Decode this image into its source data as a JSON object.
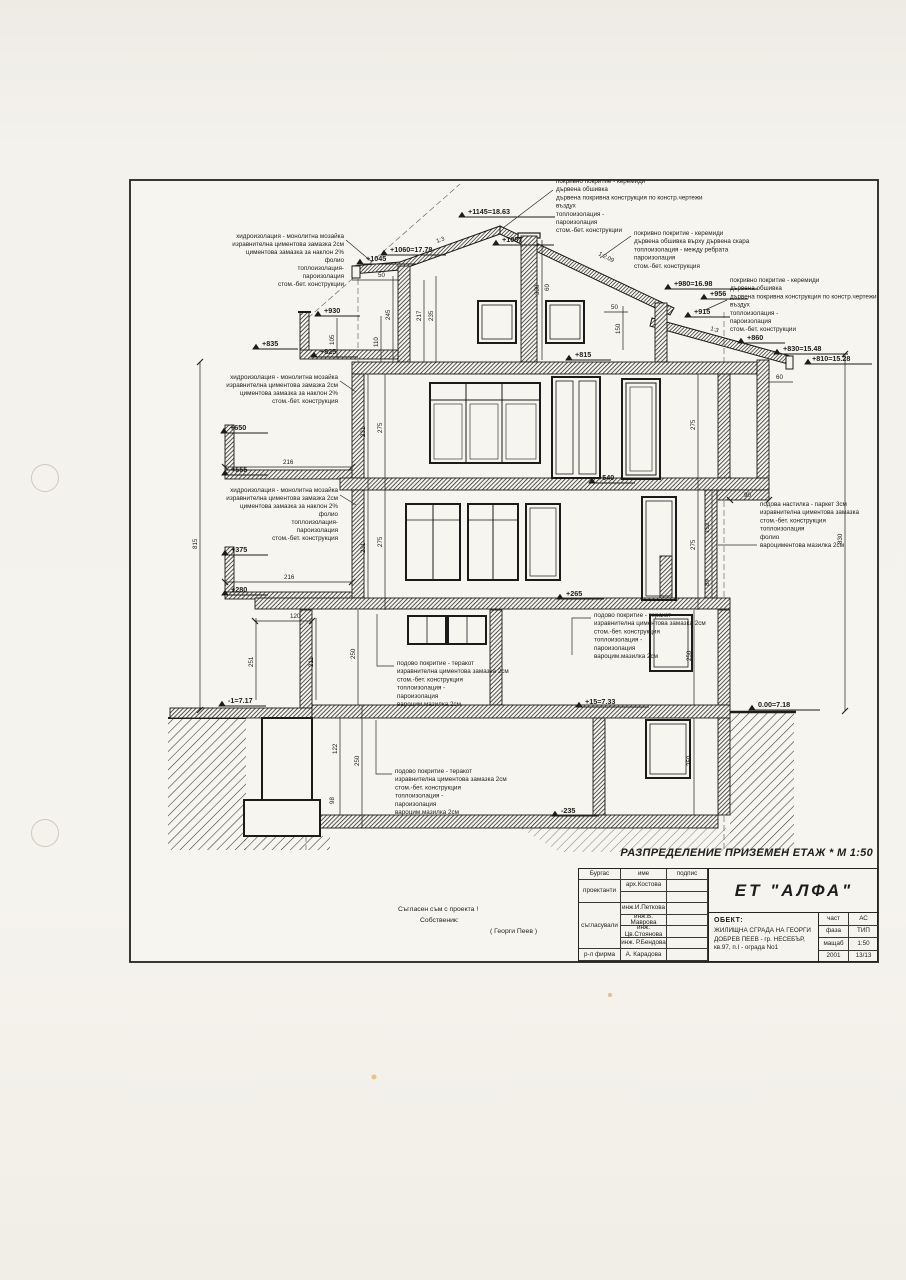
{
  "page": {
    "title": "РАЗПРЕДЕЛЕНИЕ ПРИЗЕМЕН ЕТАЖ * М 1:50"
  },
  "marks": [
    "+1145=18.63",
    "+1087",
    "+1060=17.78",
    "+1045",
    "+930",
    "+835",
    "+825",
    "+980=16.98",
    "+956",
    "+915",
    "+860",
    "+830=15.48",
    "+810=15.28",
    "+815",
    "+650",
    "+555",
    "+540",
    "+375",
    "+280",
    "+265",
    "+15=7.33",
    "-1=7.17",
    "0.00=7.18",
    "-235"
  ],
  "dims": [
    "330",
    "60",
    "245",
    "217",
    "235",
    "105",
    "110",
    "50",
    "50",
    "150",
    "60",
    "231",
    "275",
    "216",
    "275",
    "231",
    "275",
    "216",
    "275",
    "815",
    "830",
    "90",
    "152",
    "89",
    "120",
    "251",
    "211",
    "250",
    "250",
    "122",
    "250",
    "98",
    "250"
  ],
  "slopes": {
    "left": "1:3",
    "right": "1:2.09",
    "lower": "1:3"
  },
  "notes": {
    "roof_frame": [
      "покривно покритие - керемиди",
      "дървена обшивка",
      "дървена покривна конструкция по констр.чертежи",
      "въздух",
      "топлоизолация -",
      "пароизолация",
      "стом.-бет. конструкции"
    ],
    "roof_batten": [
      "покривно покритие - керемиди",
      "дървена обшивка върху дървена скара",
      "топлоизолация - между ребрата",
      "пароизолация",
      "стом.-бет. конструкция"
    ],
    "hydro_top": [
      "хидроизолация - монолитна мозайка",
      "изравнителна циментова замазка 2см",
      "циментова замазка за наклон 2%",
      "фолио",
      "топлоизолация-",
      "пароизолация",
      "стом.-бет. конструкции"
    ],
    "hydro_mid": [
      "хидроизолация - монолитна мозайка",
      "изравнителна циментова замазка 2см",
      "циментова замазка за наклон 2%",
      "стом.-бет. конструкция"
    ],
    "hydro_low": [
      "хидроизолация - монолитна мозайка",
      "изравнителна циментова замазка 2см",
      "циментова замазка за наклон 2%",
      "фолио",
      "топлоизолация-",
      "пароизолация",
      "стом.-бет. конструкция"
    ],
    "parquet": [
      "подова настилка - паркет 3см",
      "изравнителна циментова замазка",
      "стом.-бет. конструкция",
      "топлоизолация",
      "фолио",
      "вароциментова мазилка 2см"
    ],
    "terracotta": [
      "подово покритие - теракот",
      "изравнителна циментова замазка 2см",
      "стом.-бет. конструкция",
      "топлоизолация -",
      "пароизолация",
      "вароцим.мазилка 2см"
    ]
  },
  "consent": {
    "line1": "Съгласен съм с проекта !",
    "line2": "Собственик:",
    "line3": "( Георги Пеев )"
  },
  "titleblock": {
    "city": "Бургас",
    "col_name": "име",
    "col_sign": "подпис",
    "role_design": "проектанти",
    "role_agree": "съгласували",
    "role_head": "р-л фирма",
    "name1": "арх.Костова",
    "name2": "инж.И.Петкова",
    "name3": "инж.В. Маврова",
    "name4": "инж. Цв.Стоянова",
    "name5": "инж. Р.Бендова",
    "name6": "А. Карадова",
    "company": "ЕТ \"АЛФА\"",
    "object_label": "ОБЕКТ:",
    "object_lines": [
      "ЖИЛИЩНА СГРАДА НА ГЕОРГИ",
      "ДОБРЕВ ПЕЕВ - гр. НЕСЕБЪР,",
      "кв.97, п.I - ограда No1"
    ],
    "meta": [
      {
        "k": "част",
        "v": "АС"
      },
      {
        "k": "фаза",
        "v": "ТИП"
      },
      {
        "k": "мащаб",
        "v": "1:50"
      },
      {
        "k": "2001",
        "v": "13/13"
      }
    ]
  }
}
